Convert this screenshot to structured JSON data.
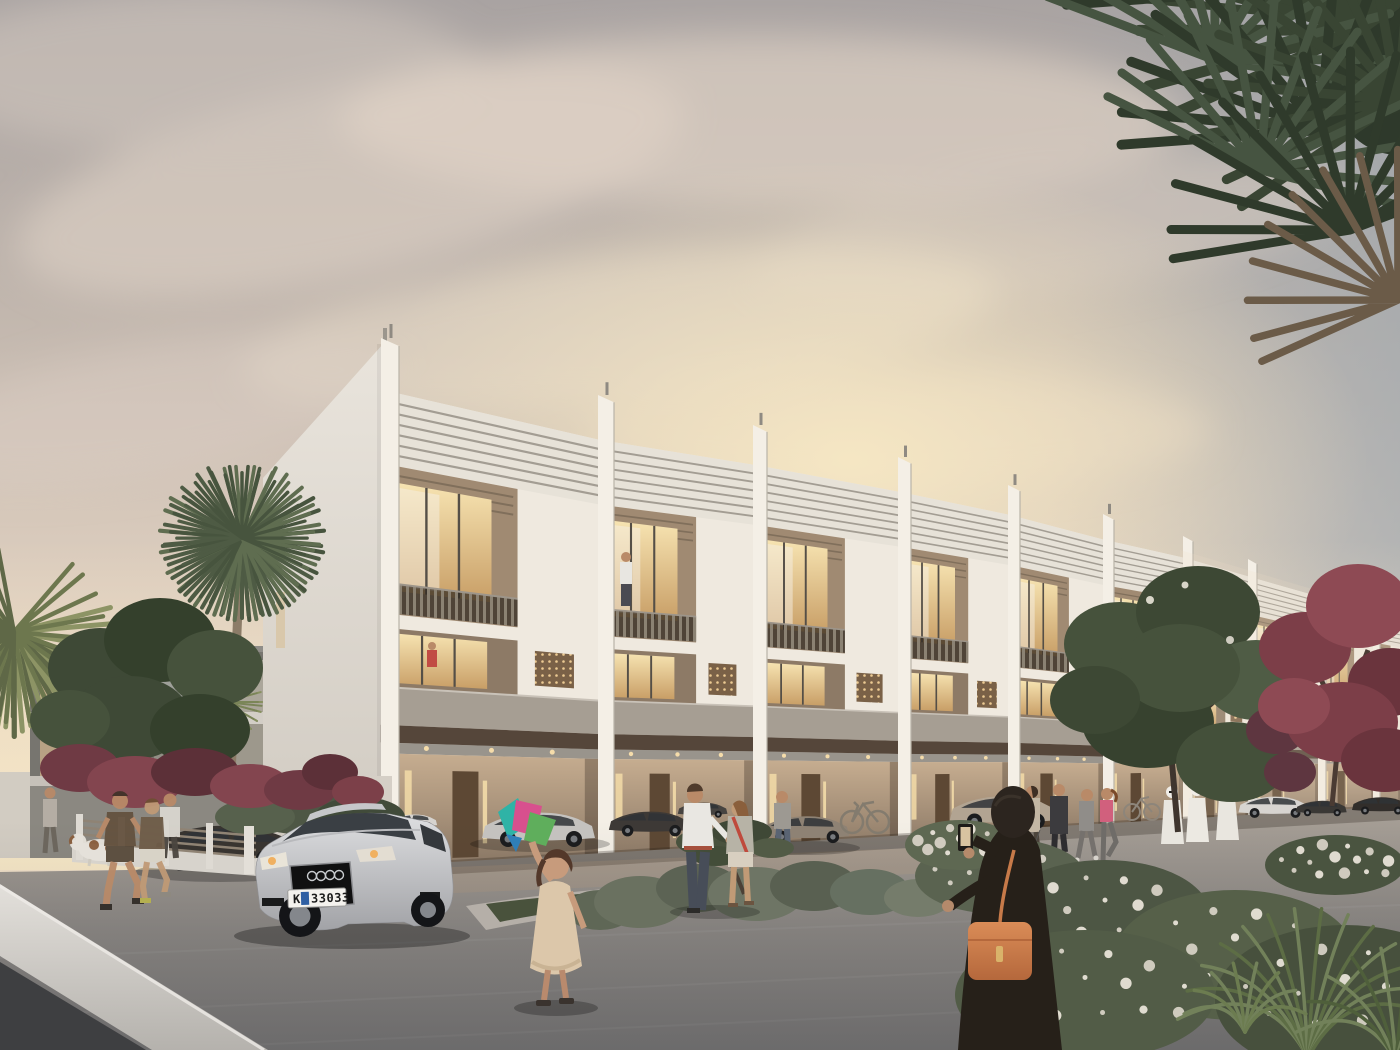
{
  "scene": {
    "title": "Residential townhouse community at dusk — architectural rendering",
    "description": "A terrace of modern three-storey white townhouses with louvred parapets, vertical fin walls, warm lit balconies, perforated bronze screens and covered ground-floor parking, seen in receding perspective at sunset. People stroll on grey paved forecourt; palms and flowering shrubs frame the view.",
    "license_plate": {
      "prefix": "K",
      "number": "33033",
      "badge_color": "#2f5fa3"
    },
    "palette": {
      "skyTop": "#a9a3a2",
      "skyMid": "#dccdbe",
      "skyGlow": "#f8e9c4",
      "skyRight": "#9aa5ae",
      "wall": "#efe9df",
      "band": "#e7e2d8",
      "bandLine": "#a39d93",
      "fin": "#f4efe6",
      "finEdge": "#b9b3a8",
      "recess": "#a08a72",
      "recess2": "#8d7a66",
      "window": "#f0d7a2",
      "frame": "#554f47",
      "rail": "#8b8273",
      "screen": "#7a6147",
      "screenHole": "#ecca92",
      "brick": "#a69e93",
      "canopy": "#55463a",
      "bay": "#c6ad90",
      "door": "#5d4834",
      "glow": "#f3dca8",
      "pavement": "#948f8a",
      "road": "#3e3f41",
      "kerb": "#dcd9d4",
      "foliageGreen": "#4c5843",
      "foliageDark": "#39442f",
      "foliageRed": "#7c3e48",
      "flowerWhite": "#e8e3d8",
      "grass": "#5d6d45",
      "carSilver": "#cbcbce",
      "carDark": "#3a3633",
      "carBronze": "#8e8274",
      "carBeige": "#b2a492",
      "carWhite": "#d8d5d1",
      "skin": "#c0946f",
      "abaya": "#262019",
      "handbag": "#cd7c4b",
      "kandura": "#e9e6df",
      "girlDress": "#dcc7aa",
      "kiteTeal": "#2fb3a6",
      "kitePink": "#d8508e",
      "kiteGreen": "#5fae5c"
    },
    "vehicles": [
      "silver Audi sedan (foreground)",
      "dark sedan",
      "white hatchback",
      "silver sedan",
      "dark sedan",
      "dark SUV",
      "bronze coupe",
      "beige car",
      "white car",
      "two dark cars (far right)"
    ],
    "people": [
      "girl with kite",
      "woman in black abaya with orange handbag taking photo",
      "chatting couple",
      "two joggers",
      "man with white dog",
      "distant walker",
      "three men in white kanduras",
      "group of four with brown dog",
      "man on balcony",
      "person in red on balcony",
      "person at doorway"
    ],
    "plants": [
      "overhanging fan-palm fronds (top right)",
      "palm tree (left)",
      "purple-red ornamental trees",
      "green trees",
      "grey-green clipped shrubs (centre bed)",
      "white flowering shrubs (right)",
      "tall grass clump (bottom right)"
    ]
  }
}
